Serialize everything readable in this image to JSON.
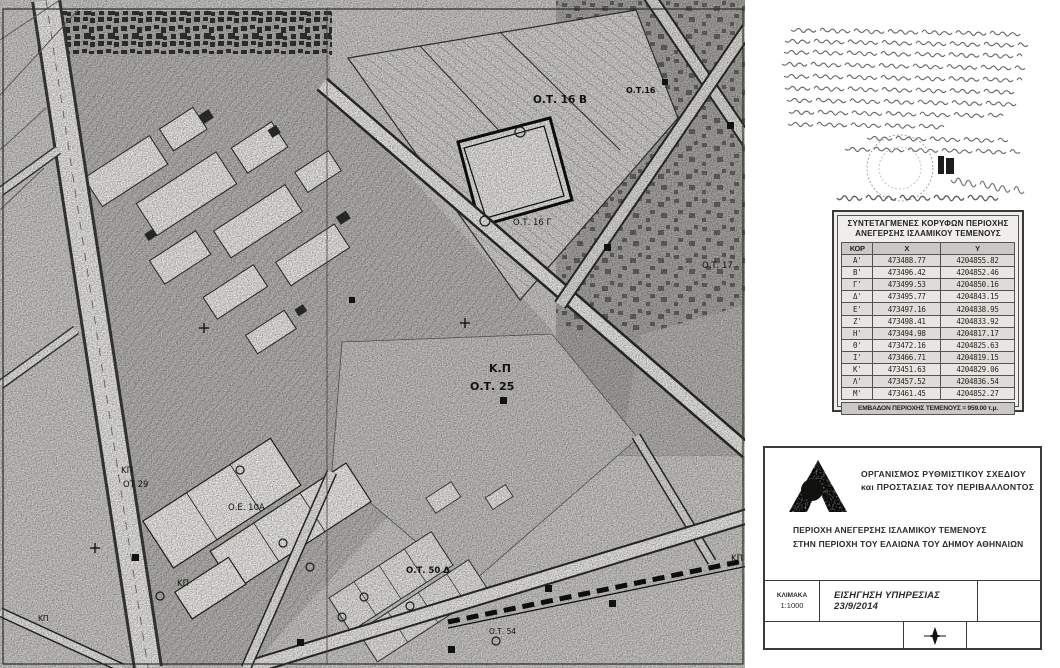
{
  "map": {
    "labels": [
      {
        "text": "Ο.Τ. 16 Β",
        "x": 533,
        "y": 103,
        "size": 10.5,
        "bold": true
      },
      {
        "text": "Ο.Τ.16",
        "x": 626,
        "y": 93,
        "size": 8,
        "bold": true
      },
      {
        "text": "Ο.Τ. 16 Γ",
        "x": 513,
        "y": 225,
        "size": 8.5,
        "bold": false
      },
      {
        "text": "Ο.Τ. 17",
        "x": 702,
        "y": 268,
        "size": 8.5,
        "bold": false
      },
      {
        "text": "Κ.Π",
        "x": 489,
        "y": 372,
        "size": 11,
        "bold": true
      },
      {
        "text": "Ο.Τ. 25",
        "x": 470,
        "y": 390,
        "size": 11,
        "bold": true
      },
      {
        "text": "ΚΠ",
        "x": 121,
        "y": 473,
        "size": 8.5,
        "bold": false
      },
      {
        "text": "ΟΤ 29",
        "x": 123,
        "y": 487,
        "size": 8.5,
        "bold": false
      },
      {
        "text": "Ο.Ε. 10Α",
        "x": 228,
        "y": 510,
        "size": 8.5,
        "bold": false
      },
      {
        "text": "ΚΠ",
        "x": 177,
        "y": 586,
        "size": 8.5,
        "bold": false
      },
      {
        "text": "Ο.Τ. 50 Δ",
        "x": 406,
        "y": 573,
        "size": 8.5,
        "bold": true
      },
      {
        "text": "ΚΠ",
        "x": 731,
        "y": 561,
        "size": 8.5,
        "bold": false
      },
      {
        "text": "Ο.Τ. 54",
        "x": 489,
        "y": 634,
        "size": 7.5,
        "bold": false
      },
      {
        "text": "ΚΠ",
        "x": 38,
        "y": 621,
        "size": 7.5,
        "bold": false
      }
    ]
  },
  "coords_table": {
    "title_line1": "ΣΥΝΤΕΤΑΓΜΕΝΕΣ ΚΟΡΥΦΩΝ ΠΕΡΙΟΧΗΣ",
    "title_line2": "ΑΝΕΓΕΡΣΗΣ ΙΣΛΑΜΙΚΟΥ ΤΕΜΕΝΟΥΣ",
    "columns": [
      "ΚΟΡ",
      "Χ",
      "Υ"
    ],
    "rows": [
      [
        "Α'",
        "473488.77",
        "4204855.82"
      ],
      [
        "Β'",
        "473496.42",
        "4204852.46"
      ],
      [
        "Γ'",
        "473499.53",
        "4204850.16"
      ],
      [
        "Δ'",
        "473495.77",
        "4204843.15"
      ],
      [
        "Ε'",
        "473497.16",
        "4204838.95"
      ],
      [
        "Ζ'",
        "473498.41",
        "4204833.92"
      ],
      [
        "Η'",
        "473494.98",
        "4204817.17"
      ],
      [
        "Θ'",
        "473472.16",
        "4204825.63"
      ],
      [
        "Ι'",
        "473466.71",
        "4204819.15"
      ],
      [
        "Κ'",
        "473451.63",
        "4204829.06"
      ],
      [
        "Λ'",
        "473457.52",
        "4204836.54"
      ],
      [
        "Μ'",
        "473461.45",
        "4204852.27"
      ]
    ],
    "footer": "ΕΜΒΑΔΟΝ ΠΕΡΙΟΧΗΣ ΤΕΜΕΝΟΥΣ = 959.00 τ.μ."
  },
  "title_block": {
    "org_line1": "ΟΡΓΑΝΙΣΜΟΣ ΡΥΘΜΙΣΤΙΚΟΥ ΣΧΕΔΙΟΥ",
    "org_line2": "και ΠΡΟΣΤΑΣΙΑΣ ΤΟΥ ΠΕΡΙΒΑΛΛΟΝΤΟΣ",
    "subject_line1": "ΠΕΡΙΟΧΗ ΑΝΕΓΕΡΣΗΣ ΙΣΛΑΜΙΚΟΥ ΤΕΜΕΝΟΥΣ",
    "subject_line2": "ΣΤΗΝ ΠΕΡΙΟΧΗ ΤΟΥ ΕΛΑΙΩΝΑ ΤΟΥ ΔΗΜΟΥ ΑΘΗΝΑΙΩΝ",
    "scale_label": "ΚΛΙΜΑΚΑ",
    "scale_value": "1:1000",
    "submission": "ΕΙΣΗΓΗΣΗ ΥΠΗΡΕΣΙΑΣ 23/9/2014"
  }
}
